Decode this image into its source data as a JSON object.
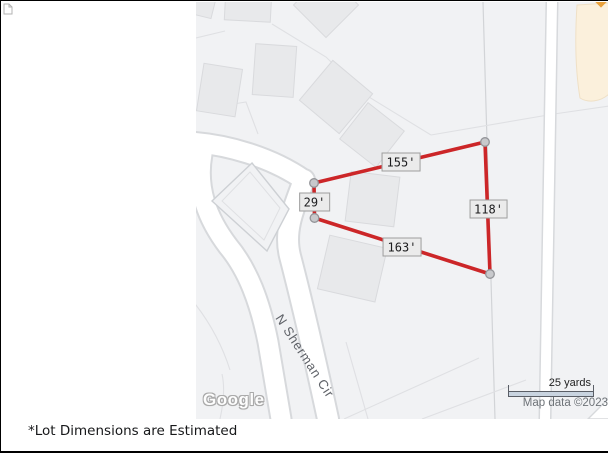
{
  "caption": "*Lot Dimensions are Estimated",
  "map": {
    "street_label": "N Sherman Cir",
    "logo_text": "Google",
    "scale_label": "25 yards",
    "attribution": "Map data ©2023",
    "dimension_labels": {
      "top": "155'",
      "left": "29'",
      "right": "118'",
      "bottom": "163'"
    }
  },
  "colors": {
    "lot-red": "#cc2628",
    "marker-fill": "#c8c9cc",
    "marker-stroke": "#939498",
    "label-bg": "#ebebeb",
    "label-border": "#9e9e9e",
    "label-text": "#1c1c1e",
    "map-bg": "#f1f2f4",
    "road-fill": "#ffffff",
    "road-casing": "#d7d9dc",
    "building-fill": "#e8e9eb",
    "building-stroke": "#d9dadd",
    "parcel-line": "#dfe0e3",
    "commercial-fill": "#fbf0dc",
    "commercial-stroke": "#efe0c6",
    "street-text": "#5f6268",
    "attribution-text": "#6e7378"
  }
}
